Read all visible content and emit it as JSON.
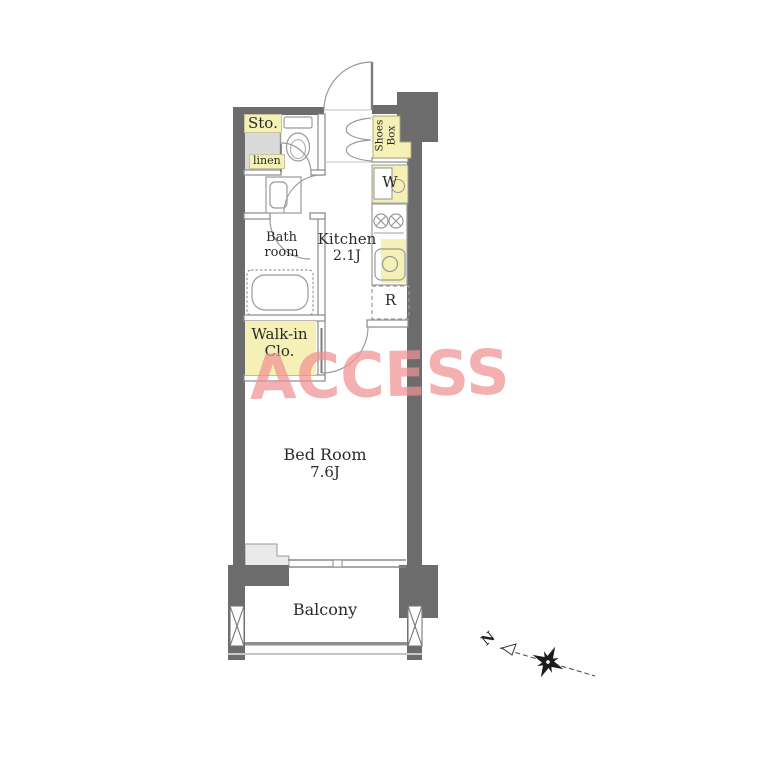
{
  "watermark": {
    "text": "ACCESS"
  },
  "colors": {
    "wall_dark": "#6c6c6c",
    "highlight_yellow": "#f5f0b5",
    "storage_gray": "#dadada",
    "watermark_pink": "#f2a0a0",
    "fixture_line": "#999999"
  },
  "rooms": {
    "storage": {
      "label": "Sto."
    },
    "linen": {
      "label": "linen"
    },
    "shoes_box": {
      "line1": "Shoes",
      "line2": "Box"
    },
    "washer": {
      "label": "W"
    },
    "kitchen": {
      "name": "Kitchen",
      "size": "2.1J"
    },
    "refrigerator": {
      "label": "R"
    },
    "bathroom": {
      "line1": "Bath",
      "line2": "room"
    },
    "walk_in_closet": {
      "line1": "Walk-in",
      "line2": "Clo."
    },
    "bedroom": {
      "name": "Bed Room",
      "size": "7.6J"
    },
    "balcony": {
      "label": "Balcony"
    }
  },
  "compass": {
    "north_label": "N"
  }
}
